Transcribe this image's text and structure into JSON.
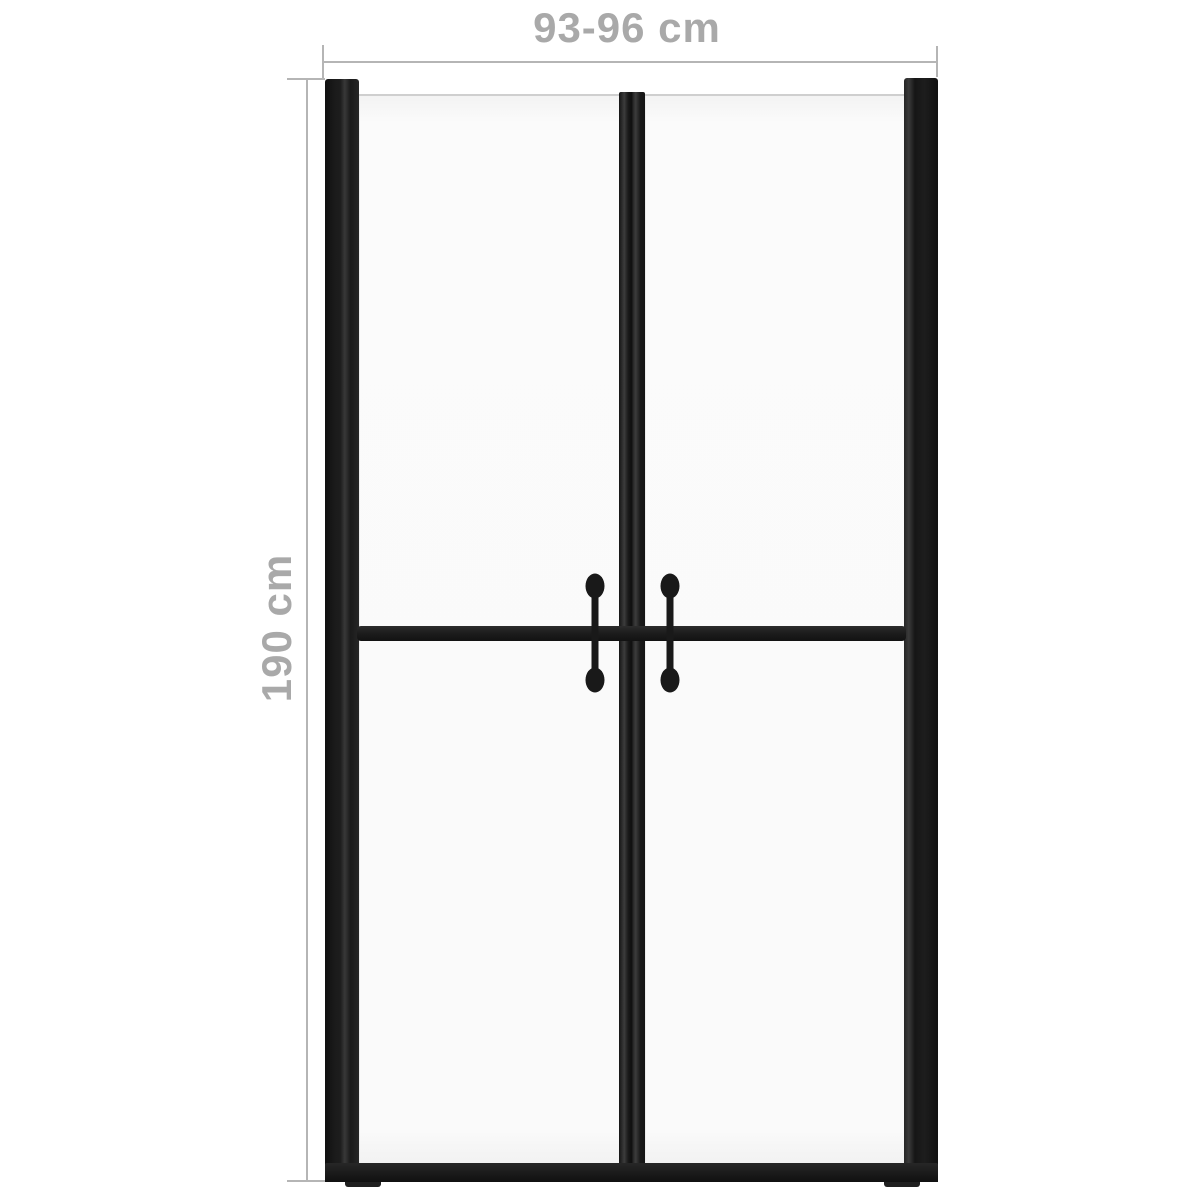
{
  "diagram": {
    "width_label": "93-96 cm",
    "height_label": "190 cm"
  },
  "colors": {
    "background": "#ffffff",
    "frame": "#1d1d1d",
    "glass": "#fafafa",
    "glass_edge": "#cfcfcf",
    "dimension_line": "#b5b5b5",
    "label_text": "#a9a9a9"
  }
}
